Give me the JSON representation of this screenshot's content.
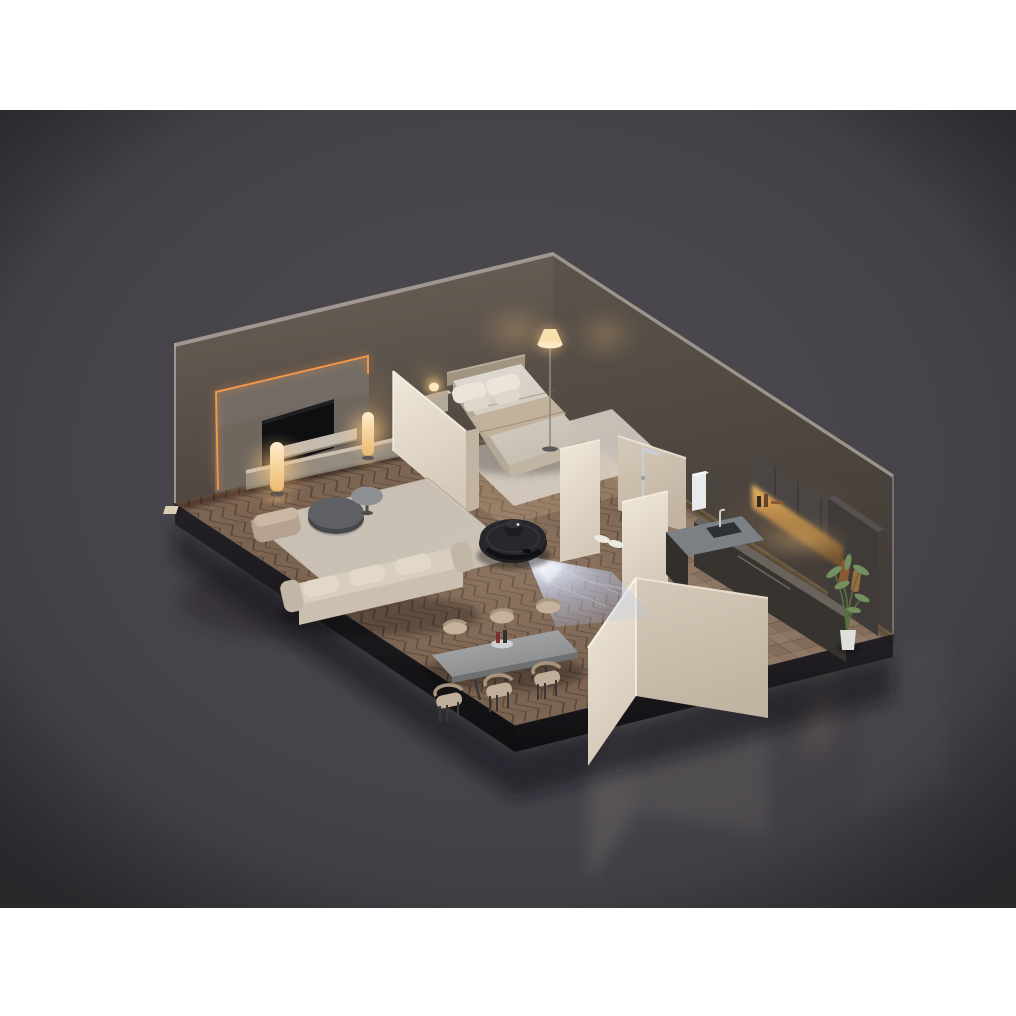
{
  "meta": {
    "description": "3D isometric cutaway render of a dimly lit one-bedroom apartment at evening. A round black robot vacuum with a LiDAR turret sits on herringbone wood flooring in the open living area and projects a blue structured-light beam onto the floor ahead of it. Rooms: living room with LED-backlit TV wall, media console, two glowing cylinder floor lamps, sofa, ottoman and round coffee tables on a rug; bedroom with a made bed, nightstand lamp and glowing cone floor lamp; bathroom nook with rain shower fixture and slippers on tile; charcoal kitchen with warm under-cabinet lighting, sink and a potted plant; dining table with six chairs. The scene sits on a dark slab over a glossy reflective dark-gray backdrop with white bands at top and bottom."
  },
  "scene": {
    "setting": "isometric apartment cutaway, evening mood lighting",
    "rooms": [
      {
        "name": "living-room",
        "objects": [
          "tv-feature-wall with orange LED accent",
          "flat-tv",
          "floating-shelf",
          "media-console",
          "cylinder-floor-lamp x2",
          "area-rug",
          "sofa",
          "ottoman",
          "round-coffee-table-large",
          "round-coffee-table-small"
        ]
      },
      {
        "name": "bedroom",
        "objects": [
          "double-bed with duvet and 4 pillows",
          "headboard",
          "bedroom-rug",
          "nightstand",
          "nightstand-lamp",
          "cone-floor-lamp"
        ]
      },
      {
        "name": "bathroom",
        "objects": [
          "shower-fixture",
          "partition-walls",
          "slippers",
          "water-heater"
        ]
      },
      {
        "name": "kitchen",
        "objects": [
          "upper-cabinets",
          "tall-cabinet",
          "under-cabinet-light",
          "counter",
          "sink",
          "faucet",
          "shelf-items",
          "hanging-boards",
          "potted-plant"
        ]
      },
      {
        "name": "dining-area",
        "objects": [
          "rectangular-dining-table",
          "dining-chair x6",
          "centerpiece-tray-with-bottles"
        ]
      }
    ],
    "robot_vacuum": {
      "body": "round charcoal robot vacuum",
      "turret": "LiDAR puck on top",
      "beam": "blue structured-light projection fanning onto the floor",
      "location": "between living area and dining area"
    },
    "floors": {
      "living_dining": "herringbone wood",
      "hallway_bath_kitchen": "stone tile",
      "bedroom": "lighter wood with pale rug"
    },
    "backdrop": {
      "top_band": "white",
      "bottom_band": "white",
      "middle": "dark gray glossy studio with reflections"
    }
  },
  "palette": {
    "white": "#ffffff",
    "bgMid": "#4e4c51",
    "bgEdge": "#39373b",
    "wallL1": "#6b6259",
    "wallL2": "#4e463f",
    "wallR1": "#5c544c",
    "wallR2": "#443d37",
    "wallCap": "#a39c93",
    "cream1": "#f0e8da",
    "cream2": "#d5c9b9",
    "cream3": "#c2b4a2",
    "wood": "#7c6452",
    "woodLine": "#3f2e20",
    "tile": "#8c7462",
    "bedwood": "#b08a62",
    "platform1": "#232125",
    "platform2": "#0f0e11",
    "accent": "#ff9a45",
    "lampGlow": "#ffc87e",
    "lampBody": "#ffeccb",
    "tv": "#0e0f11",
    "panel": "#6f665e",
    "console": "#c9c0b2",
    "consoleFace": "#948c7f",
    "sofa1": "#d8cec0",
    "sofa2": "#c2b7a7",
    "rug": "#d0c9bd",
    "bedrug": "#dad4ca",
    "duvet1": "#e2ddd5",
    "duvet2": "#c6bfb2",
    "blanket": "#c2b29c",
    "pillow": "#eae4da",
    "headboard": "#a29482",
    "tableTop1": "#aeafb1",
    "tableTop2": "#88898b",
    "chairSeat": "#c4b29c",
    "chairLeg": "#3a3836",
    "cabinet": "#4b4644",
    "counterTop": "#6a625c",
    "steel": "#7a8084",
    "chrome": "#c9ccd0",
    "plant": "#74905f",
    "plantDark": "#55703f",
    "pot": "#dededc",
    "slipper": "#eceae4",
    "robot1": "#34373b",
    "robot2": "#17181a",
    "beam": "#a9bfef",
    "beamCore": "#eef3ff"
  }
}
